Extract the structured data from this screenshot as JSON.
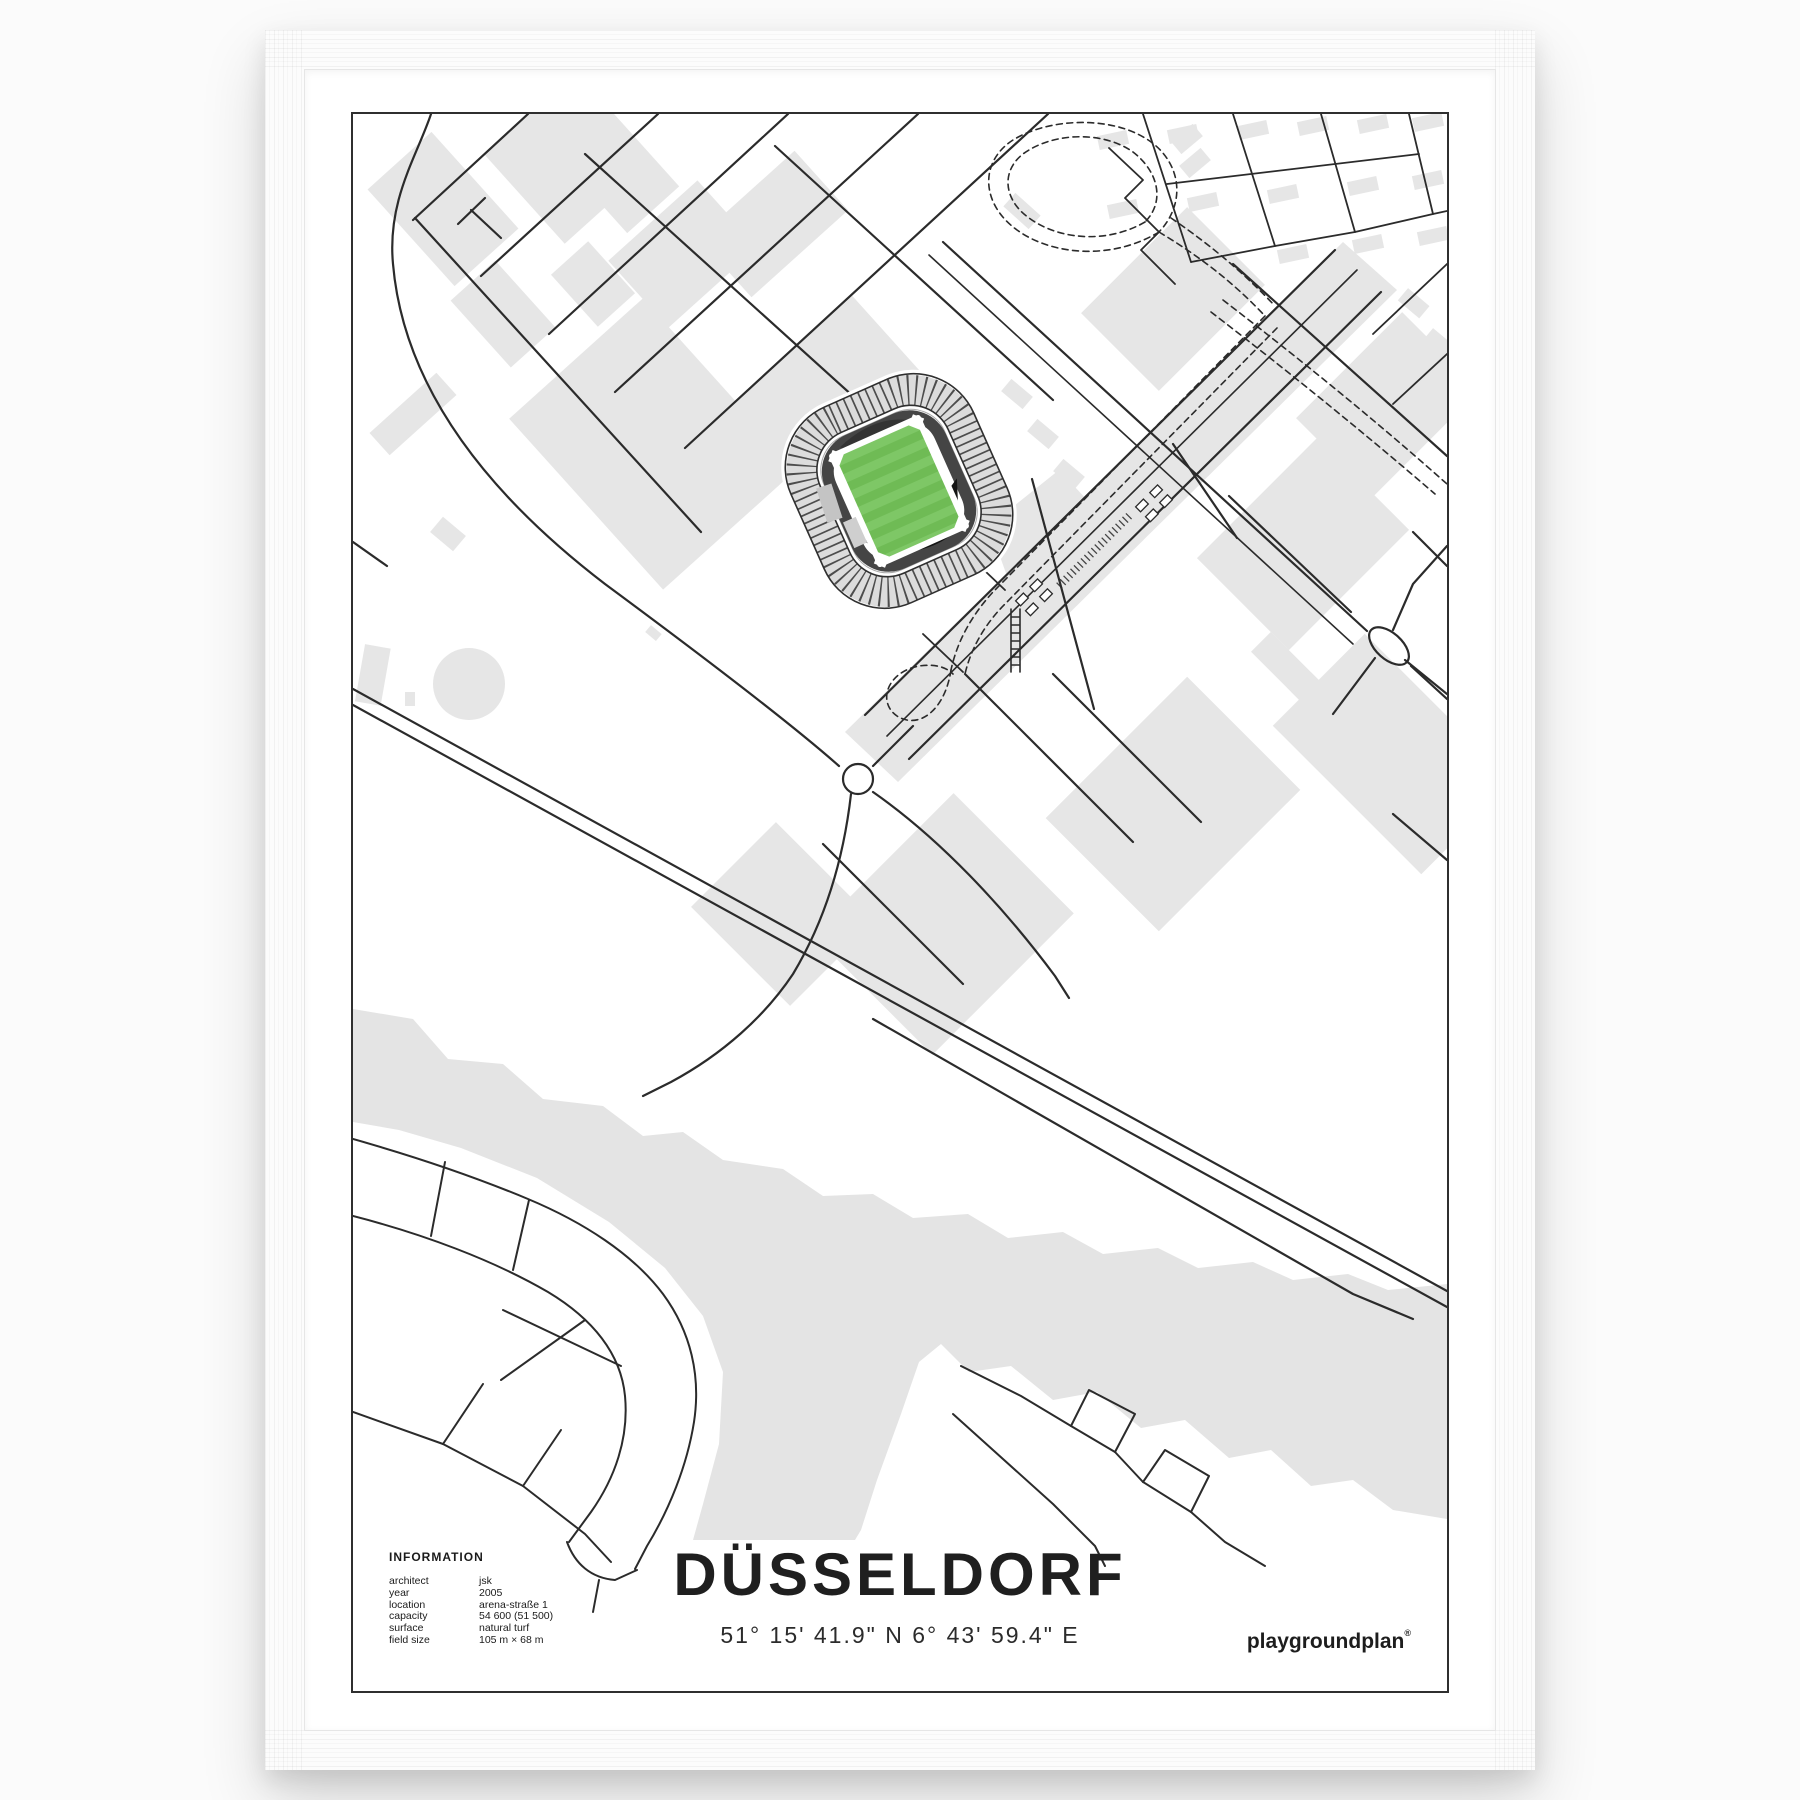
{
  "poster": {
    "title": "DÜSSELDORF",
    "coordinates": "51° 15' 41.9\" N  6° 43' 59.4\" E",
    "brand": {
      "name": "playgroundplan",
      "mark": "®"
    },
    "information": {
      "heading": "INFORMATION",
      "rows": [
        {
          "label": "architect",
          "value": "jsk"
        },
        {
          "label": "year",
          "value": "2005"
        },
        {
          "label": "location",
          "value": "arena-straße 1"
        },
        {
          "label": "capacity",
          "value": "54 600 (51 500)"
        },
        {
          "label": "surface",
          "value": "natural turf"
        },
        {
          "label": "field size",
          "value": "105 m × 68 m"
        }
      ]
    },
    "map": {
      "highlight": "stadium-pitch",
      "colors": {
        "pitch_stripe_light": "#7ec766",
        "pitch_stripe_dark": "#6fbb55",
        "urban_fill": "#e6e6e6",
        "river_fill": "#e4e4e4",
        "line": "#2b2b2b"
      }
    }
  }
}
